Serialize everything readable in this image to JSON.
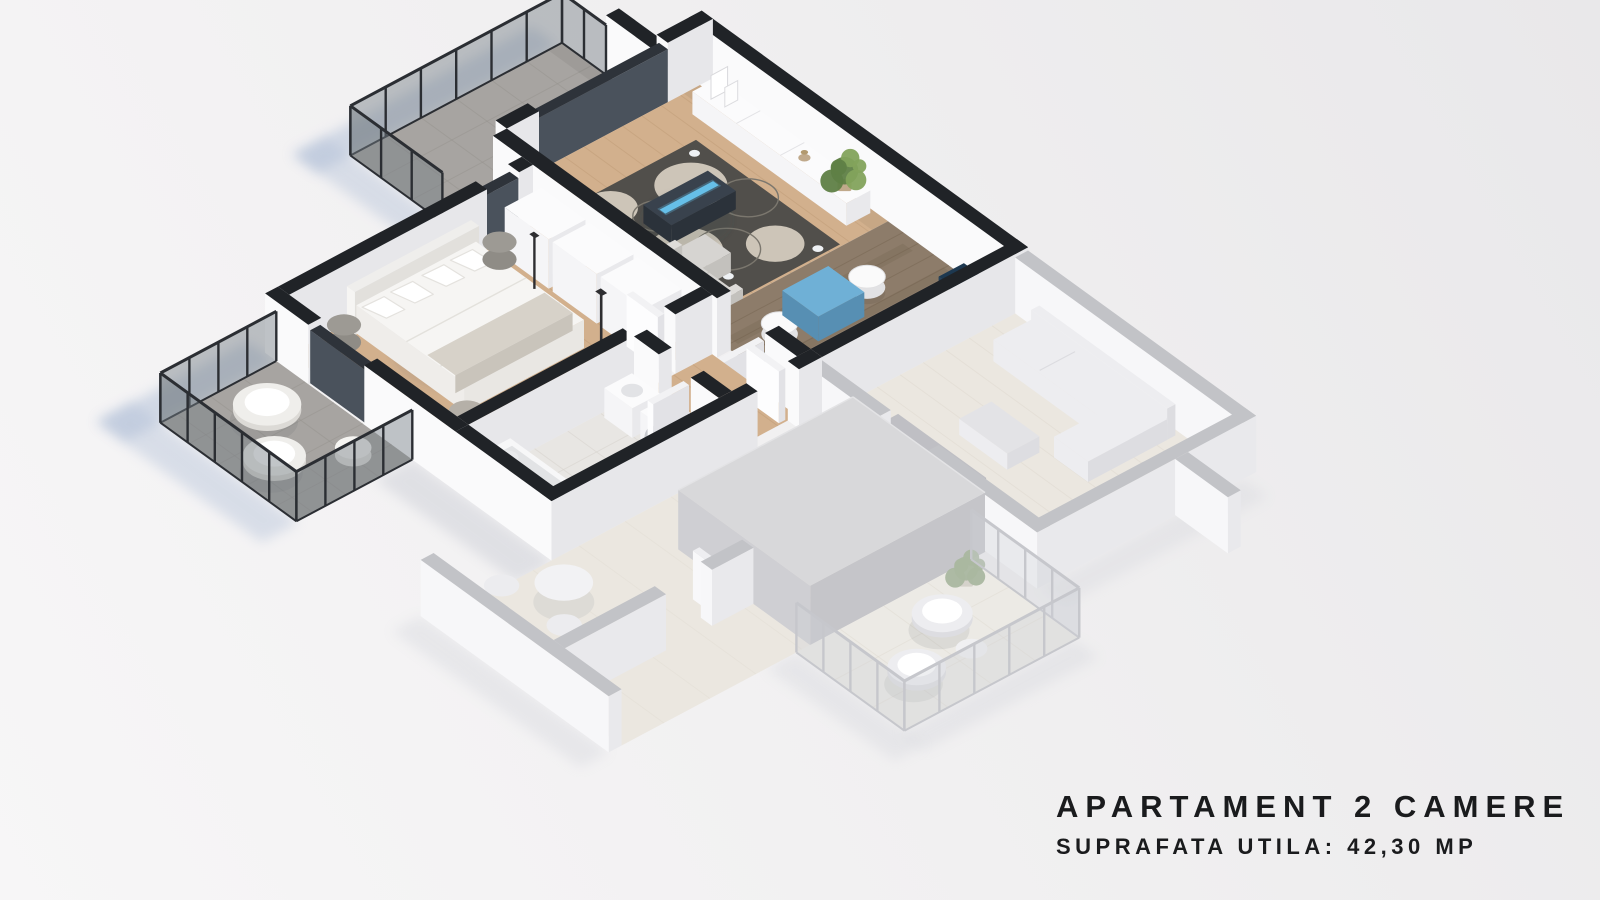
{
  "branding": {
    "line1": "APARTAMENT 2 CAMERE",
    "line2": "SUPRAFATA UTILA: 42,30 MP"
  },
  "palette": {
    "text": "#1a1b1d",
    "wall_top": "#202327",
    "wall_face_bright": "#fafafb",
    "wall_face_shade": "#e7e7ea",
    "glass_dark_top": "#2e333a",
    "glass_dark_face": "#4a525c",
    "rail_frame": "#2b2e33",
    "rail_glass": "rgba(118,126,134,0.45)",
    "wood_light": "#d2b08d",
    "wood_light_line": "#bf9c77",
    "wood_dark": "#8d7c6a",
    "wood_dark_line": "#74634f",
    "tile_balcony": "#a7a4a1",
    "tile_line": "#96938e",
    "bath_floor": "#e8e6e3",
    "bath_line": "#d8d4cf",
    "rug": "#514f4b",
    "rug_circle": "#cdc5b8",
    "rug_circle_line": "#7b776e",
    "sofa": "#d6d4d1",
    "sofa_shade": "#c3c1bd",
    "white_top": "#fbfbfc",
    "white_se": "#e9e9ec",
    "white_sw": "#f5f5f7",
    "tv_top": "#39424d",
    "tv_side": "#2b323a",
    "tv_accent": "#66bfe9",
    "dining_top": "#6fb0d6",
    "dining_side": "#578fb3",
    "counter_navy": "#1d3850",
    "counter_navy_dark": "#152a3c",
    "counter_blue": "#aec8da",
    "mat_blue": "#b9d2e2",
    "sink_beige": "#cdbfa6",
    "bed_duvet": "#f6f5f3",
    "bed_side": "#e9e7e3",
    "bed_base": "#dcdad6",
    "bed_throw": "#d7d2c9",
    "headboard": "#efeeec",
    "night_gray": "#9d9a94",
    "stool": "#b5b0a8",
    "lamp_dark": "#2e2e31",
    "plant_dark": "#5f7f46",
    "plant_light": "#83a35c",
    "pot": "#c0a98b",
    "shadow_blue": "#aebdd6",
    "shadow_gray": "#bcc0ca",
    "n_wall_top": "#c2c3c7",
    "n_wall_face": "#f7f7f9",
    "n_wall_shade": "#e9e9ec",
    "n_floor": "#ebe7e0",
    "n_floor_line": "#ddd7cd",
    "n_slab_top": "#d8d8da",
    "n_slab_se": "#c5c5c9",
    "n_slab_sw": "#cfcfd3",
    "n_furn": "#ededf0",
    "n_furn_shade": "#dddde1",
    "n_dark": "#bfbfc4",
    "n_rail": "#c6c7cc",
    "n_glass": "rgba(205,210,216,0.35)",
    "n_plant": "#aab7a0"
  }
}
